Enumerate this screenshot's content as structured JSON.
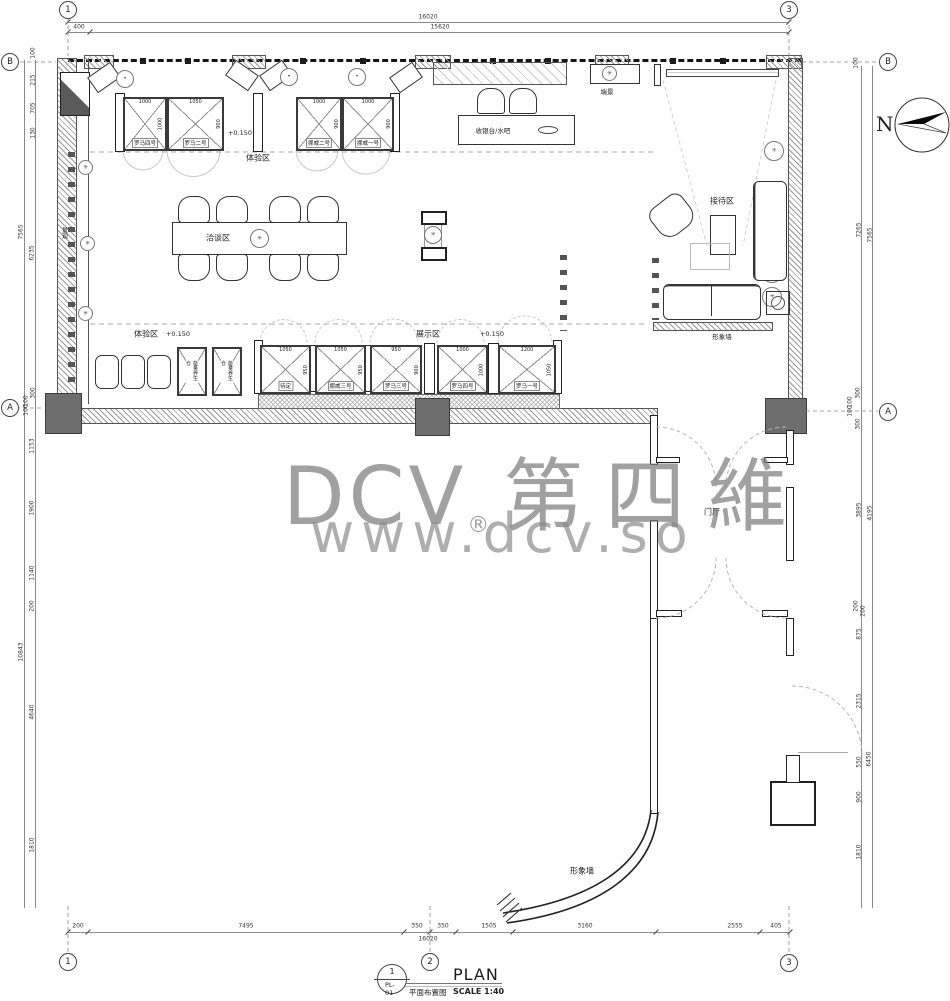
{
  "watermark": {
    "brand": "DCV",
    "reg": "®",
    "cjk": "第四維",
    "url": "www.dcv.so"
  },
  "titleblock": {
    "num": "1",
    "sheet": "PL-01",
    "cn": "平面布置图",
    "en": "PLAN",
    "scale": "SCALE 1:40"
  },
  "north": "N",
  "grid": {
    "c1": "1",
    "c2": "2",
    "c3": "3",
    "rA": "A",
    "rB": "B"
  },
  "labels": {
    "experience_top": "体验区",
    "experience_bottom": "体验区",
    "display_zone": "展示区",
    "negotiation": "洽谈区",
    "reception": "接待区",
    "cashier": "收银台/水吧",
    "endview": "端景",
    "foyer": "门厅",
    "image_wall_reception": "形象墙",
    "image_wall_curve": "形象墙",
    "landscape": "景观",
    "level_top": "+0.150",
    "level_exp": "+0.150",
    "level_disp": "+0.150",
    "pod1": "能量养生仓",
    "pod2": "能量养生仓"
  },
  "booths_top": [
    {
      "name": "罗马四号",
      "w": "1000",
      "h": "1000"
    },
    {
      "name": "罗马二号",
      "w": "1050",
      "h": "900"
    },
    {
      "name": "挪威二号",
      "w": "1000",
      "h": "900"
    },
    {
      "name": "挪威一号",
      "w": "1000",
      "h": "900"
    }
  ],
  "booths_bottom": [
    {
      "name": "待定",
      "w": "1050",
      "h": "950"
    },
    {
      "name": "挪威三号",
      "w": "1050",
      "h": "950"
    },
    {
      "name": "罗马三号",
      "w": "950",
      "h": "900"
    },
    {
      "name": "罗马四号",
      "w": "1000",
      "h": "1000"
    },
    {
      "name": "罗马一号",
      "w": "1200",
      "h": "1050"
    }
  ],
  "dims": {
    "top": {
      "total": "16020",
      "inner": "15620",
      "left": "400"
    },
    "bottom": {
      "segs": [
        "200",
        "7495",
        "350",
        "350",
        "1505",
        "3160",
        "2555",
        "405"
      ],
      "total": "16020"
    },
    "left": [
      "100",
      "215",
      "705",
      "130",
      "7565",
      "6235",
      "300",
      "100",
      "100",
      "1153",
      "1900",
      "1140",
      "200",
      "10843",
      "4640",
      "1810"
    ],
    "right": [
      "100",
      "7265",
      "7565",
      "300",
      "100",
      "100",
      "300",
      "3895",
      "4195",
      "200",
      "200",
      "875",
      "2315",
      "550",
      "6450",
      "900",
      "1810"
    ]
  }
}
